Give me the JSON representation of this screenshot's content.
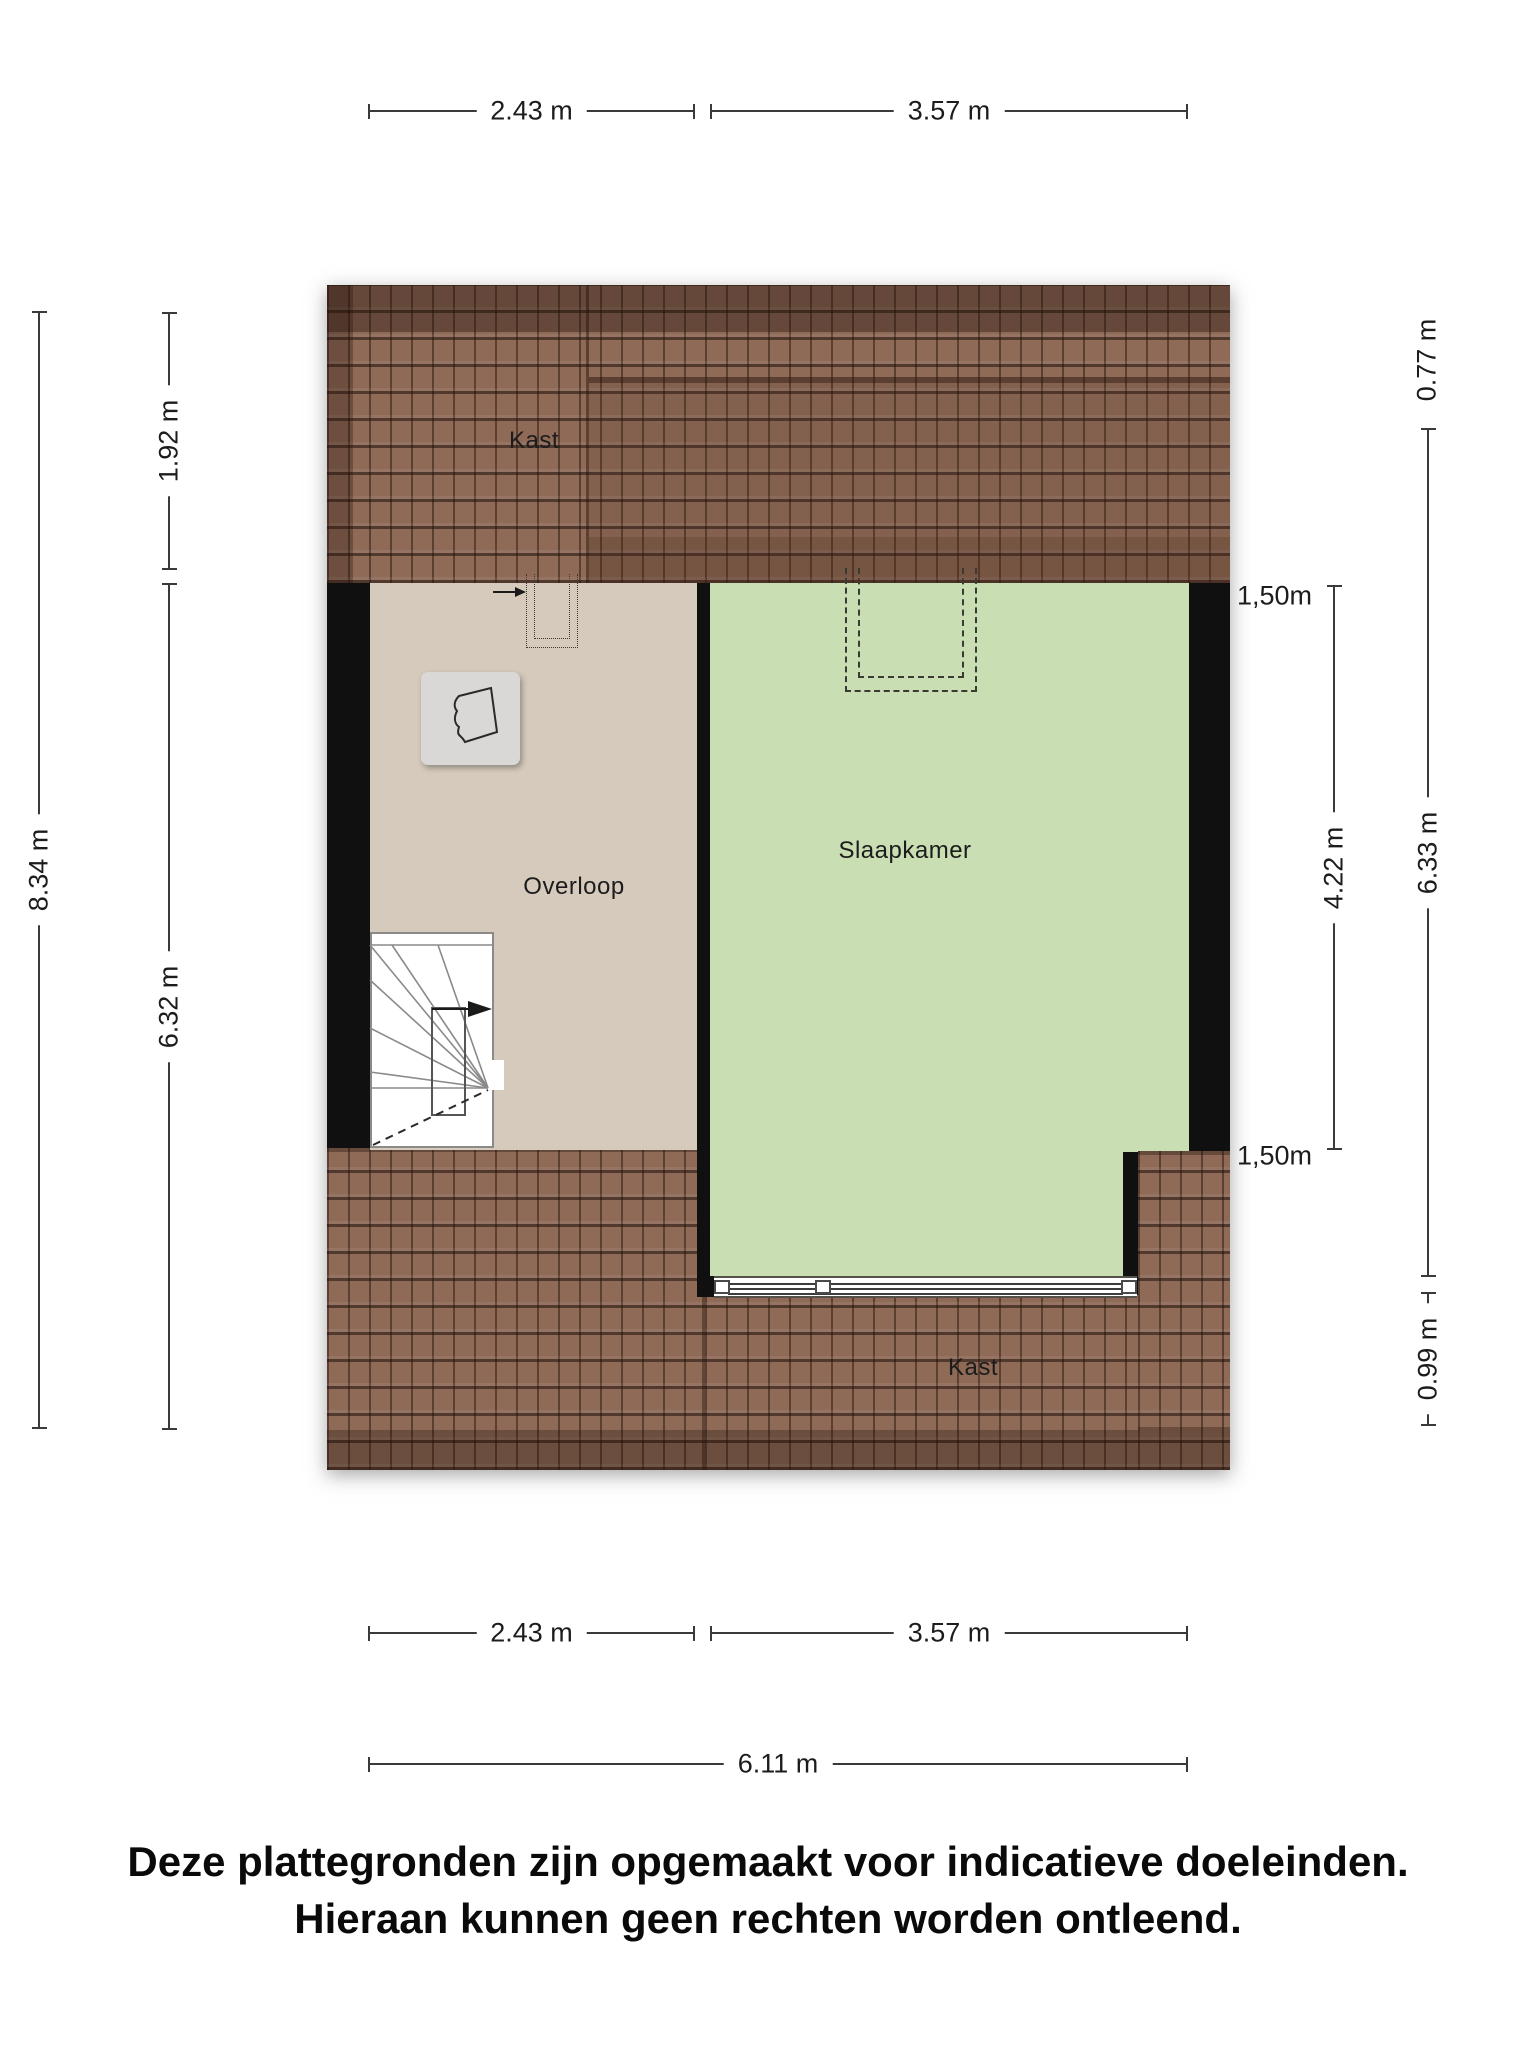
{
  "title": "Floor plan - second floor (attic)",
  "rooms": {
    "kast_top": "Kast",
    "overloop": "Overloop",
    "slaapkamer": "Slaapkamer",
    "kast_bottom": "Kast"
  },
  "dimensions": {
    "top": [
      {
        "label": "2.43 m"
      },
      {
        "label": "3.57 m"
      }
    ],
    "bottom": [
      {
        "label": "2.43 m"
      },
      {
        "label": "3.57 m"
      },
      {
        "label": "6.11 m"
      }
    ],
    "left": [
      {
        "label": "8.34 m"
      },
      {
        "label": "1.92 m"
      },
      {
        "label": "6.32 m"
      }
    ],
    "right": [
      {
        "label": "0.77 m"
      },
      {
        "label": "6.33 m"
      },
      {
        "label": "4.22 m"
      },
      {
        "label": "0.99 m"
      }
    ],
    "knee_wall": [
      {
        "label": "1,50m"
      },
      {
        "label": "1,50m"
      }
    ]
  },
  "disclaimer": {
    "line1": "Deze plattegronden zijn opgemaakt voor indicatieve doeleinden.",
    "line2": "Hieraan kunnen geen rechten worden ontleend."
  },
  "colors": {
    "roof_base": "#8e6a57",
    "floor": "#d6cabc",
    "room": "#c9deb3",
    "wall": "#101010",
    "dim": "#3a3a3a"
  }
}
